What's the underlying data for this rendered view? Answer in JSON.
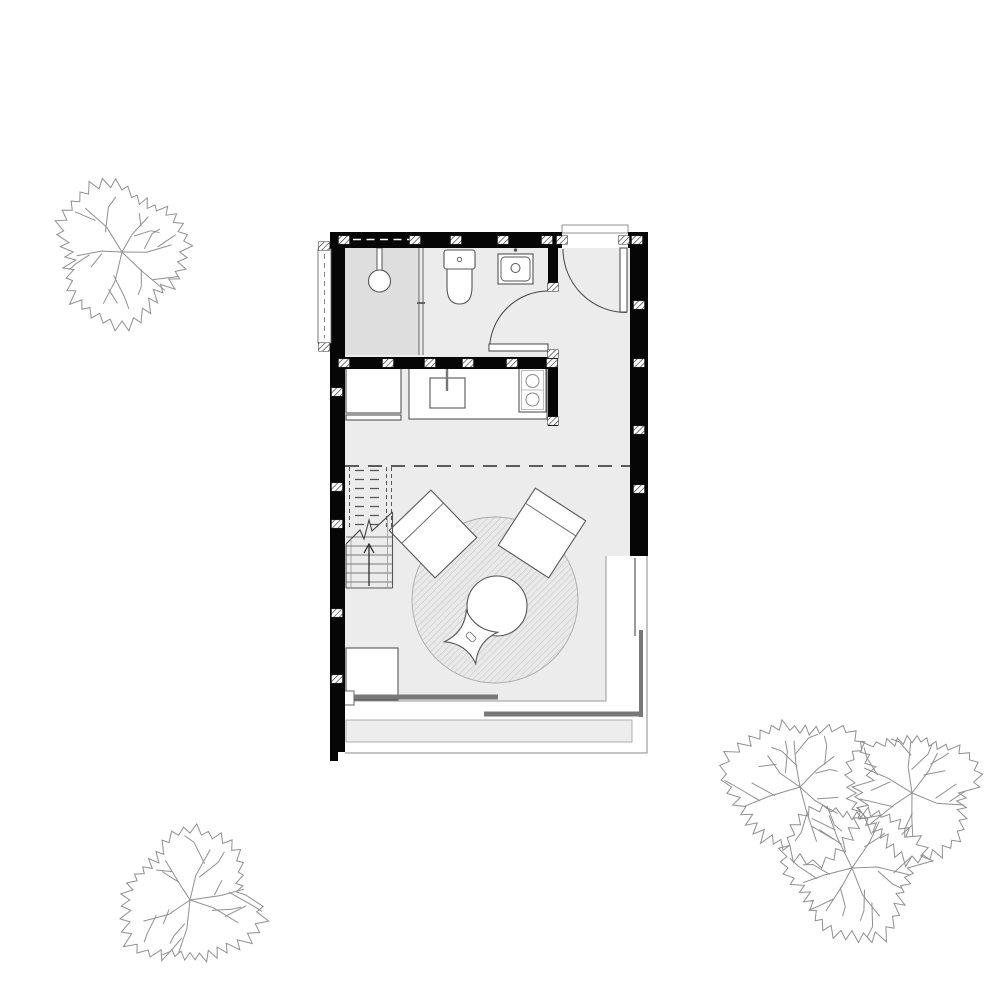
{
  "drawing": {
    "kind": "architectural floor plan, ground floor of a small studio cabin",
    "visible_text": [],
    "palette": {
      "wall": "#060606",
      "floor": "#ececec",
      "shower_floor": "#dedede",
      "deck": "#ededed",
      "line": "#555555",
      "line_mid": "#777777",
      "line_light": "#9a9a9a",
      "tree_line": "#8f8f8f",
      "sliding_panel": "#787878",
      "rug_hatch": "#bdbdbd"
    }
  },
  "plan": {
    "rug": {
      "cx": 495,
      "cy": 600,
      "r": 83
    },
    "table": {
      "cx": 497,
      "cy": 606,
      "r": 30
    },
    "pouf": {
      "cx": 471,
      "cy": 637,
      "tip": 27,
      "waist": 8,
      "rot": -10
    },
    "stairs": {
      "x1": 346,
      "x2": 392.5,
      "dash_top": 467,
      "dash_bottom": 527,
      "dash_tread_x1": 355,
      "dash_tread_x2": 384,
      "solid_top": 537,
      "solid_bottom": 588,
      "step": 9,
      "rails_x": [
        344.5,
        349.5,
        386.5,
        391.5
      ]
    },
    "section_line": {
      "y": 466,
      "x1": 345,
      "x2": 630
    },
    "wall_ticks": [
      {
        "x": 344,
        "y": 240
      },
      {
        "x": 415,
        "y": 240
      },
      {
        "x": 456,
        "y": 240
      },
      {
        "x": 503,
        "y": 240
      },
      {
        "x": 547,
        "y": 240
      },
      {
        "x": 562,
        "y": 240
      },
      {
        "x": 624,
        "y": 240
      },
      {
        "x": 637,
        "y": 240
      },
      {
        "x": 344,
        "y": 363
      },
      {
        "x": 388,
        "y": 363
      },
      {
        "x": 430,
        "y": 363
      },
      {
        "x": 468,
        "y": 363
      },
      {
        "x": 512,
        "y": 363
      },
      {
        "x": 552,
        "y": 363
      },
      {
        "x": 337,
        "y": 392
      },
      {
        "x": 337,
        "y": 487
      },
      {
        "x": 337,
        "y": 524
      },
      {
        "x": 337,
        "y": 613
      },
      {
        "x": 337,
        "y": 679
      },
      {
        "x": 639,
        "y": 305
      },
      {
        "x": 639,
        "y": 363
      },
      {
        "x": 639,
        "y": 430
      },
      {
        "x": 639,
        "y": 489
      },
      {
        "x": 553,
        "y": 287
      },
      {
        "x": 553,
        "y": 354
      },
      {
        "x": 553,
        "y": 421
      },
      {
        "x": 324,
        "y": 246
      },
      {
        "x": 324,
        "y": 347
      }
    ]
  },
  "site": {
    "trees": [
      {
        "cx": 122,
        "cy": 252,
        "r": 78,
        "seed": 3
      },
      {
        "cx": 190,
        "cy": 900,
        "r": 77,
        "seed": 7
      },
      {
        "cx": 800,
        "cy": 787,
        "r": 82,
        "seed": 11
      },
      {
        "cx": 912,
        "cy": 793,
        "r": 73,
        "seed": 17
      },
      {
        "cx": 852,
        "cy": 868,
        "r": 78,
        "seed": 23
      }
    ]
  }
}
